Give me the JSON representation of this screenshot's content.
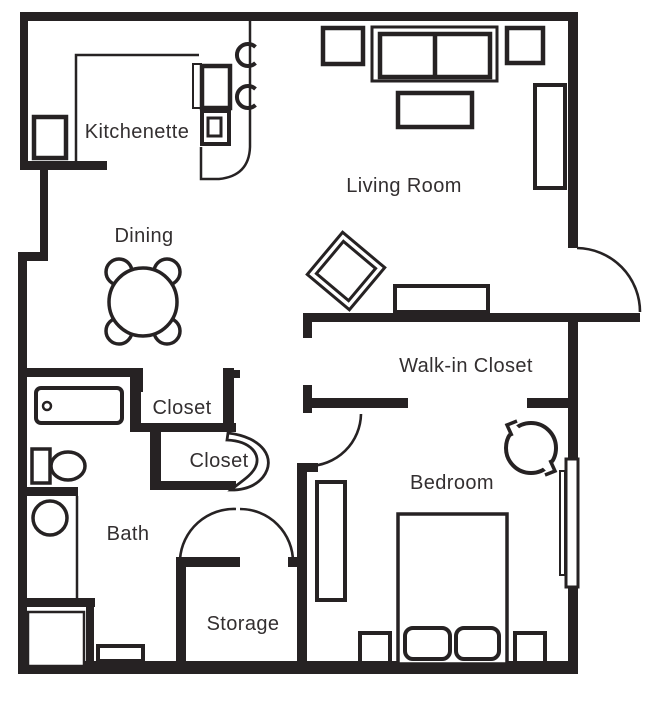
{
  "floor_plan": {
    "rooms": [
      {
        "label": "Kitchenette"
      },
      {
        "label": "Living Room"
      },
      {
        "label": "Dining"
      },
      {
        "label": "Walk-in Closet"
      },
      {
        "label": "Closet"
      },
      {
        "label": "Closet"
      },
      {
        "label": "Bath"
      },
      {
        "label": "Bedroom"
      },
      {
        "label": "Storage"
      }
    ],
    "colors": {
      "wall": "#262223",
      "line": "#262223",
      "text": "#332f30",
      "background": "#ffffff"
    }
  }
}
